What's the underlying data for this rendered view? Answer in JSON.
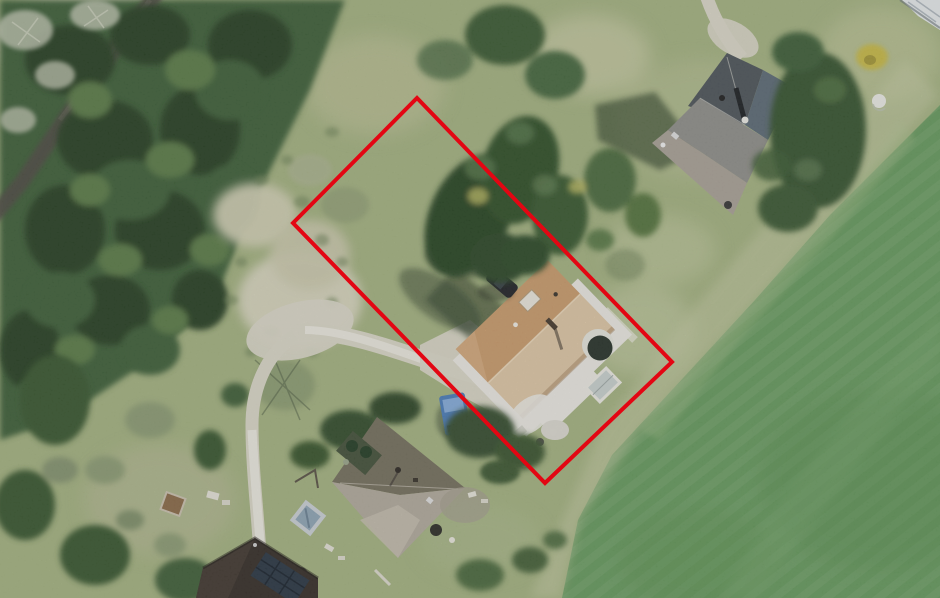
{
  "image": {
    "width": 940,
    "height": 598,
    "kind": "aerial-photograph"
  },
  "annotation": {
    "parcel_outline": {
      "points": "417,98 672,362 545,483 293,223",
      "stroke_width": 4,
      "color_key": "parcel_red"
    }
  },
  "features": {
    "forest": "dense conifer forest, north-west",
    "access_road": "dark lane crossing the forest diagonally",
    "clearing": "pale gravel clearing at west corner of parcel",
    "driveway": "light gravel drive curving to southern houses",
    "subject_house": "tan hip-roof house inside the red outline",
    "parked_car": "dark car north-west of subject house",
    "conservatory": "dark round conservatory on east side of subject house",
    "neighbor_house_north": "grey cross-gable roof house, north-east",
    "neighbor_house_south": "beige hip-roof house, south",
    "neighbor_house_southwest": "dark roof with solar panels, bottom-left corner",
    "camper_van": "blue van parked south-west of subject house",
    "field": "uniform green meadow, east and south-east",
    "hot_tub": "covered hot tub near southern house",
    "yellow_bush": "yellow flowering bush near north-east house",
    "white_rock": "white boulder in north-east lawn"
  },
  "palette": {
    "grass_base": "#a3b181",
    "grass_pale": "#d3d1ba",
    "field_green": "#67995f",
    "forest_mid": "#41613a",
    "forest_dark": "#2b4326",
    "canopy_light": "#5c7c49",
    "road_dark": "#4f4d45",
    "path_light": "#d8d5c6",
    "path_white": "#ebe9e0",
    "roof_tan_dark": "#c89b6d",
    "roof_tan_light": "#dcc5a5",
    "roof_gray_dark": "#4f565b",
    "roof_gray_mid": "#8f8e8a",
    "roof_gray_light": "#a8a096",
    "roof_beige_dark": "#75705f",
    "roof_beige_light": "#b0a99c",
    "roof_darkhouse": "#37302a",
    "solar_panel": "#2c3845",
    "car_dark": "#23262a",
    "van_blue": "#4d7db8",
    "white_structure": "#e8e6e0",
    "shadow_green": "#35462e",
    "parcel_red": "#e30613",
    "yellow_bush": "#c9b83e",
    "hot_tub": "#c9ced3"
  }
}
